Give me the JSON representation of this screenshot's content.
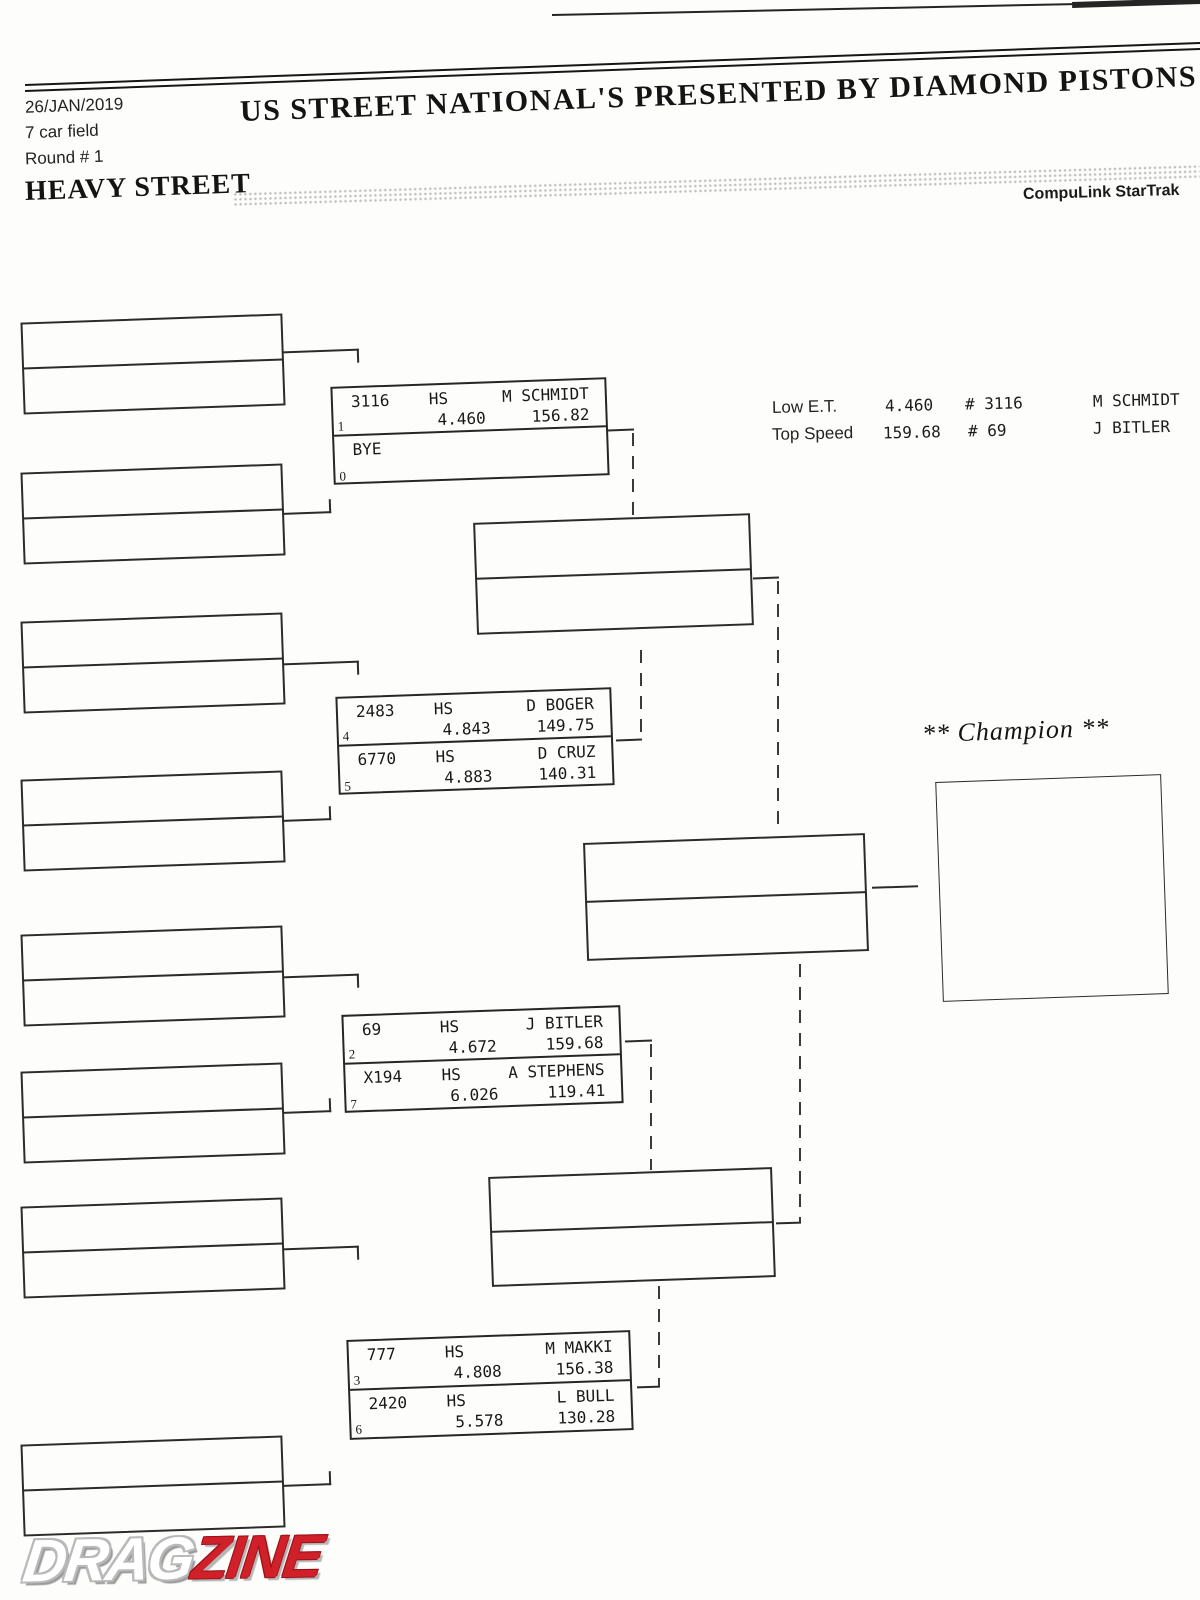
{
  "header": {
    "date": "26/JAN/2019",
    "field_size": "7 car field",
    "round": "Round # 1",
    "title": "US STREET NATIONAL'S PRESENTED BY DIAMOND PISTONS",
    "class_name": "HEAVY STREET",
    "timing_system": "CompuLink StarTrak"
  },
  "stats": {
    "low_et": {
      "label": "Low  E.T.",
      "value": "4.460",
      "car_number": "# 3116",
      "driver": "M SCHMIDT"
    },
    "top_speed": {
      "label": "Top Speed",
      "value": "159.68",
      "car_number": "# 69",
      "driver": "J BITLER"
    }
  },
  "bracket": {
    "champion_label": "** Champion **",
    "matches": [
      {
        "entries": [
          {
            "lane": "1",
            "car": "3116",
            "class": "HS",
            "driver": "M SCHMIDT",
            "et": "4.460",
            "speed": "156.82"
          },
          {
            "lane": "0",
            "car": "BYE",
            "class": "",
            "driver": "",
            "et": "",
            "speed": ""
          }
        ]
      },
      {
        "entries": [
          {
            "lane": "4",
            "car": "2483",
            "class": "HS",
            "driver": "D BOGER",
            "et": "4.843",
            "speed": "149.75"
          },
          {
            "lane": "5",
            "car": "6770",
            "class": "HS",
            "driver": "D CRUZ",
            "et": "4.883",
            "speed": "140.31"
          }
        ]
      },
      {
        "entries": [
          {
            "lane": "2",
            "car": "69",
            "class": "HS",
            "driver": "J BITLER",
            "et": "4.672",
            "speed": "159.68"
          },
          {
            "lane": "7",
            "car": "X194",
            "class": "HS",
            "driver": "A STEPHENS",
            "et": "6.026",
            "speed": "119.41"
          }
        ]
      },
      {
        "entries": [
          {
            "lane": "3",
            "car": "777",
            "class": "HS",
            "driver": "M MAKKI",
            "et": "4.808",
            "speed": "156.38"
          },
          {
            "lane": "6",
            "car": "2420",
            "class": "HS",
            "driver": "L BULL",
            "et": "5.578",
            "speed": "130.28"
          }
        ]
      }
    ]
  },
  "logo": {
    "drag": "DRAG",
    "zine": "ZINE"
  }
}
